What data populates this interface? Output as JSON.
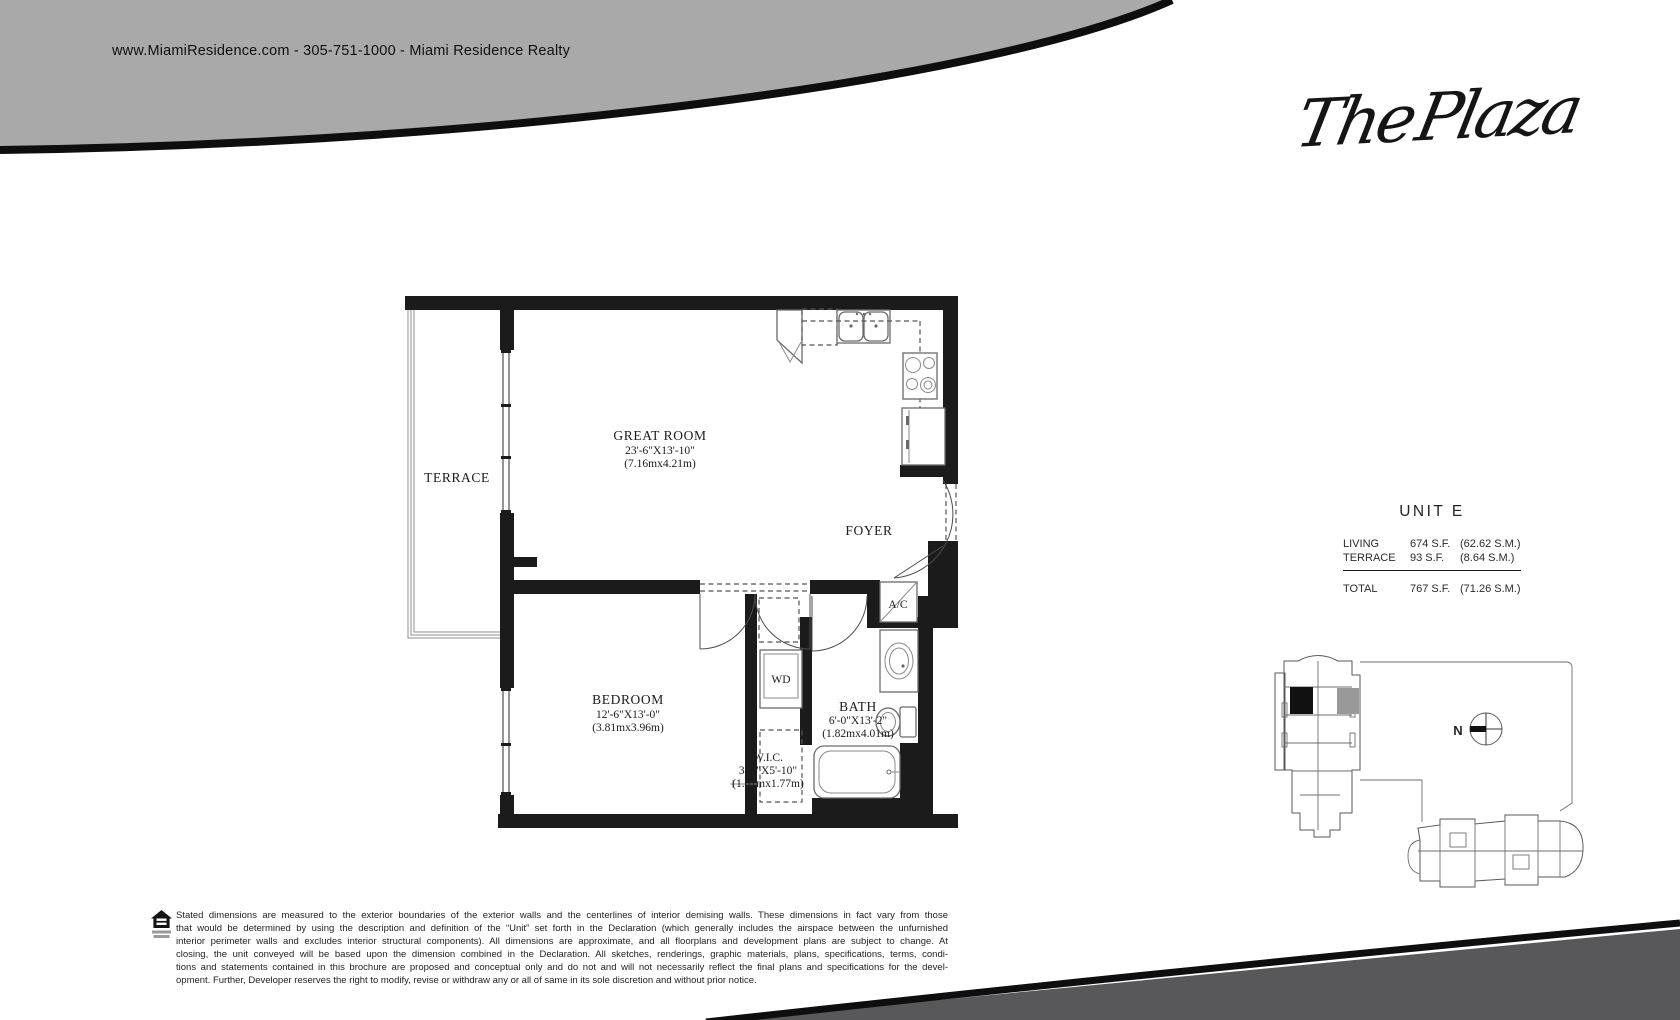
{
  "header": {
    "contact_line": "www.MiamiResidence.com  -  305-751-1000  -  Miami Residence Realty"
  },
  "logo": {
    "text": "The Plaza"
  },
  "unit_info": {
    "title": "UNIT E",
    "rows": [
      {
        "label": "LIVING",
        "sf": "674 S.F.",
        "sm": "(62.62 S.M.)"
      },
      {
        "label": "TERRACE",
        "sf": "93 S.F.",
        "sm": "(8.64 S.M.)"
      }
    ],
    "total": {
      "label": "TOTAL",
      "sf": "767 S.F.",
      "sm": "(71.26 S.M.)"
    }
  },
  "floor_plan": {
    "rooms": {
      "terrace": {
        "name": "TERRACE"
      },
      "great_room": {
        "name": "GREAT ROOM",
        "dims_ft": "23'-6\"X13'-10\"",
        "dims_m": "(7.16mx4.21m)"
      },
      "foyer": {
        "name": "FOYER"
      },
      "ac": {
        "name": "A/C"
      },
      "wd": {
        "name": "WD"
      },
      "bath": {
        "name": "BATH",
        "dims_ft": "6'-0\"X13'-2\"",
        "dims_m": "(1.82mx4.01m)"
      },
      "bedroom": {
        "name": "BEDROOM",
        "dims_ft": "12'-6\"X13'-0\"",
        "dims_m": "(3.81mx3.96m)"
      },
      "wic": {
        "name": "W.I.C.",
        "dims_ft": "3'-4\"X5'-10\"",
        "dims_m": "(1.01mx1.77m)"
      }
    }
  },
  "keyplan": {
    "compass_label": "N"
  },
  "disclaimer": {
    "lines": [
      "Stated dimensions are measured to the exterior boundaries of the exterior walls and the centerlines of interior demising walls. These dimensions in fact vary from those",
      "that would be determined by using the description and definition of the “Unit” set forth in the Declaration (which generally includes the airspace between the unfurnished",
      "interior perimeter walls and excludes interior structural components). All dimensions are approximate, and all floorplans and development plans are subject to change. At",
      "closing, the unit conveyed will be based upon the dimension combined in the Declaration. All sketches, renderings, graphic materials, plans, specifications, terms, condi-",
      "tions and statements contained in this brochure are proposed and conceptual only and do not and will not necessarily reflect the final plans and specifications for the devel-",
      "opment. Further, Developer reserves the right to modify, revise or withdraw any or all of same in its sole discretion and without prior notice."
    ]
  },
  "colors": {
    "top_band_gray": "#a9a9a9",
    "swoosh_black": "#0e0e0e",
    "bottom_band_gray": "#58585a",
    "keyplan_unit_black": "#111111",
    "keyplan_unit_gray": "#999999"
  }
}
